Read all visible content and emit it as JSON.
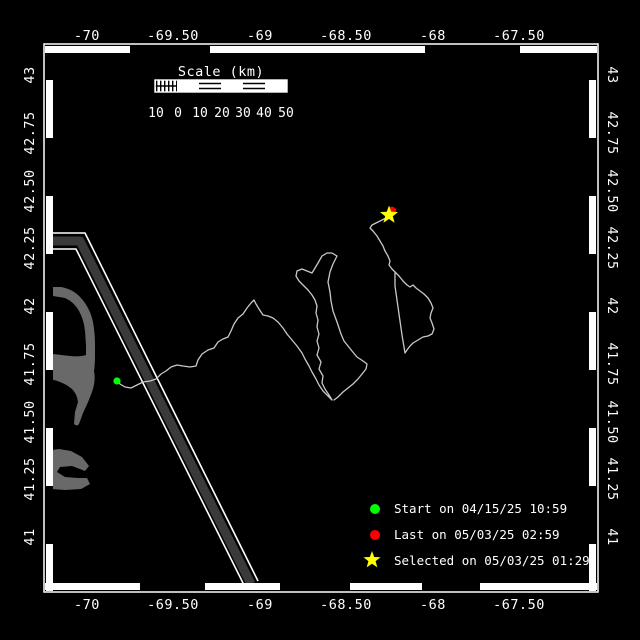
{
  "map": {
    "axes": {
      "top_labels": [
        "-70",
        "-69.50",
        "-69",
        "-68.50",
        "-68",
        "-67.50"
      ],
      "bottom_labels": [
        "-70",
        "-69.50",
        "-69",
        "-68.50",
        "-68",
        "-67.50"
      ],
      "left_labels": [
        "43",
        "42.75",
        "42.50",
        "42.25",
        "42",
        "41.75",
        "41.50",
        "41.25",
        "41"
      ],
      "right_labels": [
        "43",
        "42.75",
        "42.50",
        "42.25",
        "42",
        "41.75",
        "41.50",
        "41.25",
        "41"
      ]
    },
    "scale_bar": {
      "title": "Scale (km)",
      "tick_labels": [
        "10",
        "0",
        "10",
        "20",
        "30",
        "40",
        "50"
      ]
    },
    "legend": {
      "start": {
        "marker": "circle",
        "color": "#00ff00",
        "label": "Start on 04/15/25 10:59"
      },
      "last": {
        "marker": "circle",
        "color": "#ff0000",
        "label": "Last on 05/03/25 02:59"
      },
      "selected": {
        "marker": "star",
        "color": "#ffff00",
        "label": "Selected on 05/03/25 01:29"
      }
    },
    "markers": {
      "start": {
        "color": "#00ff00",
        "x": 117,
        "y": 381
      },
      "last": {
        "color": "#ff0000",
        "x": 392,
        "y": 211
      },
      "selected": {
        "color": "#ffff00",
        "x": 389,
        "y": 215
      }
    },
    "colors": {
      "background": "#000000",
      "frame": "#ffffff",
      "track": "#c8c8c8",
      "coastline": "#696969",
      "shipping_lane": "#3a3a3a"
    }
  }
}
